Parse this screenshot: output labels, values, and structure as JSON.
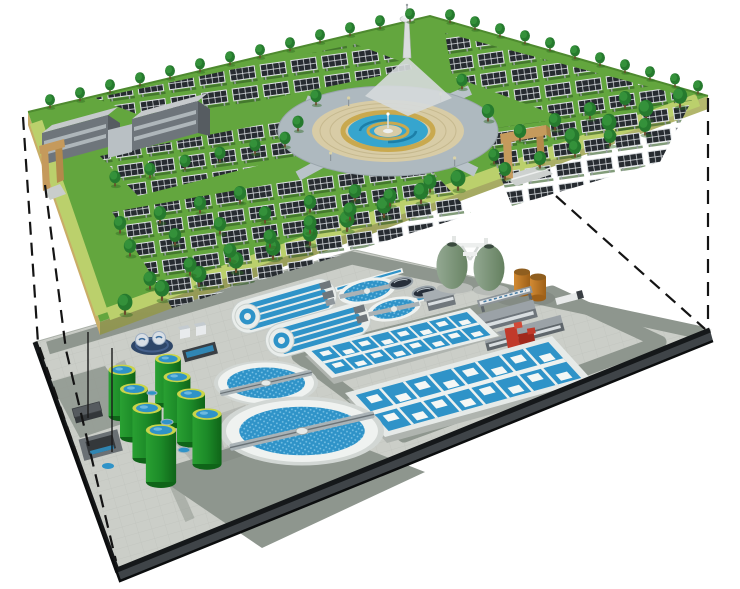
{
  "canvas": {
    "width": 740,
    "height": 589,
    "background": "#ffffff"
  },
  "colors": {
    "background": "#ffffff",
    "park_grass": "#63A63E",
    "park_border_light": "#BBD06C",
    "park_side_tan": "#C9AD67",
    "park_side_olive": "#A8AE66",
    "tree_green": "#267A2E",
    "solar_panel_dark": "#262B30",
    "plaza_pavers": "#D8CCA6",
    "plaza_ring_road": "#AEB9BF",
    "fountain_water": "#36A5CE",
    "fountain_ring_yellow": "#C9A94F",
    "tower_white": "#DADDDE",
    "building_gray": "#6E757B",
    "gate_tan": "#C59A5C",
    "pavement": "#CBCEC8",
    "road_gray": "#8E968E",
    "platform_edge_dark": "#15181A",
    "platform_side_gray": "#3F4448",
    "water_blue": "#2F93C8",
    "water_light": "#7CC3E6",
    "structure_white": "#E9EDEB",
    "tank_green_light": "#29A032",
    "tank_green_dark": "#157018",
    "tank_rim_yellow": "#C9D44A",
    "digester_sage_light": "#93A892",
    "digester_sage_dark": "#64805F",
    "tank_orange": "#C4822F",
    "machine_red": "#C13A2B",
    "unit_navy": "#2E4668",
    "projection_line": "#141414"
  },
  "scene": {
    "description": "Cutaway rendering: landscaped solar park at ground level above an underground wastewater treatment plant, linked by dashed projection lines",
    "upper_level_features": [
      "solar-panel-arrays",
      "trees",
      "central-fountain-plaza",
      "observation-tower",
      "service-buildings",
      "entrance-gates"
    ],
    "lower_level_features": [
      "oxidation-ditches",
      "circular-clarifiers",
      "aeration-basins",
      "egg-digesters",
      "green-storage-tanks",
      "orange-tanks",
      "plant-buildings",
      "inlet-works"
    ],
    "counts": {
      "circular_clarifiers": 2,
      "aeration_basins": 2,
      "oxidation_ditches": 2,
      "egg_digesters": 2,
      "green_storage_tanks": 8,
      "orange_tanks": 2,
      "small_covered_tanks": 2,
      "round_process_tanks": 2,
      "surface_buildings": 2,
      "entrance_gates": 2,
      "projection_lines": 4
    }
  }
}
